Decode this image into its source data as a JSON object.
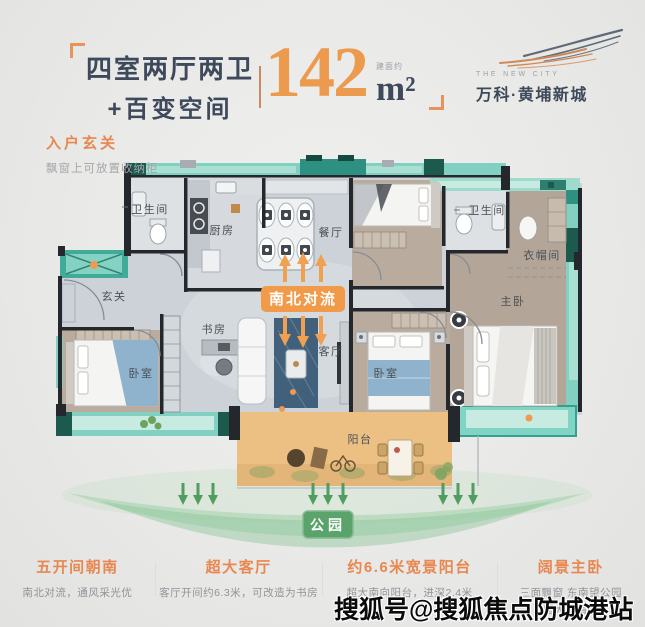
{
  "header": {
    "title_line1": "四室两厅两卫",
    "title_line2": "+百变空间",
    "area_note": "建面约",
    "area_value": "142",
    "area_unit": "m²"
  },
  "logo": {
    "en": "THE NEW CITY",
    "cn": "万科·黄埔新城"
  },
  "callout": {
    "title": "入户玄关",
    "note": "飘窗上可放置收纳柜"
  },
  "floorplan": {
    "flow_badge": "南北对流",
    "rooms": [
      {
        "label": "卫生间"
      },
      {
        "label": "厨房"
      },
      {
        "label": "餐厅"
      },
      {
        "label": "卫生间"
      },
      {
        "label": "衣帽间"
      },
      {
        "label": "玄关"
      },
      {
        "label": "书房"
      },
      {
        "label": "客厅"
      },
      {
        "label": "卧室"
      },
      {
        "label": "卧室"
      },
      {
        "label": "主卧"
      },
      {
        "label": "阳台"
      }
    ]
  },
  "park": {
    "label": "公园"
  },
  "features": [
    {
      "title": "五开间朝南",
      "sub": "南北对流，通风采光优"
    },
    {
      "title": "超大客厅",
      "sub": "客厅开间约6.3米，可改造为书房"
    },
    {
      "title": "约6.6米宽景阳台",
      "sub": "超大南向阳台，进深2.4米"
    },
    {
      "title": "阔景主卧",
      "sub": "三面飘窗 东南望公园",
      "sub2": "超大衣帽间"
    }
  ],
  "watermark": "搜狐号@搜狐焦点防城港站",
  "colors": {
    "accent_orange": "#ec9a4d",
    "title_navy": "#3e4a5c",
    "teal_band": "#82d0c2",
    "park_green": "#5aa36a",
    "balcony_tan": "#ecc083"
  }
}
